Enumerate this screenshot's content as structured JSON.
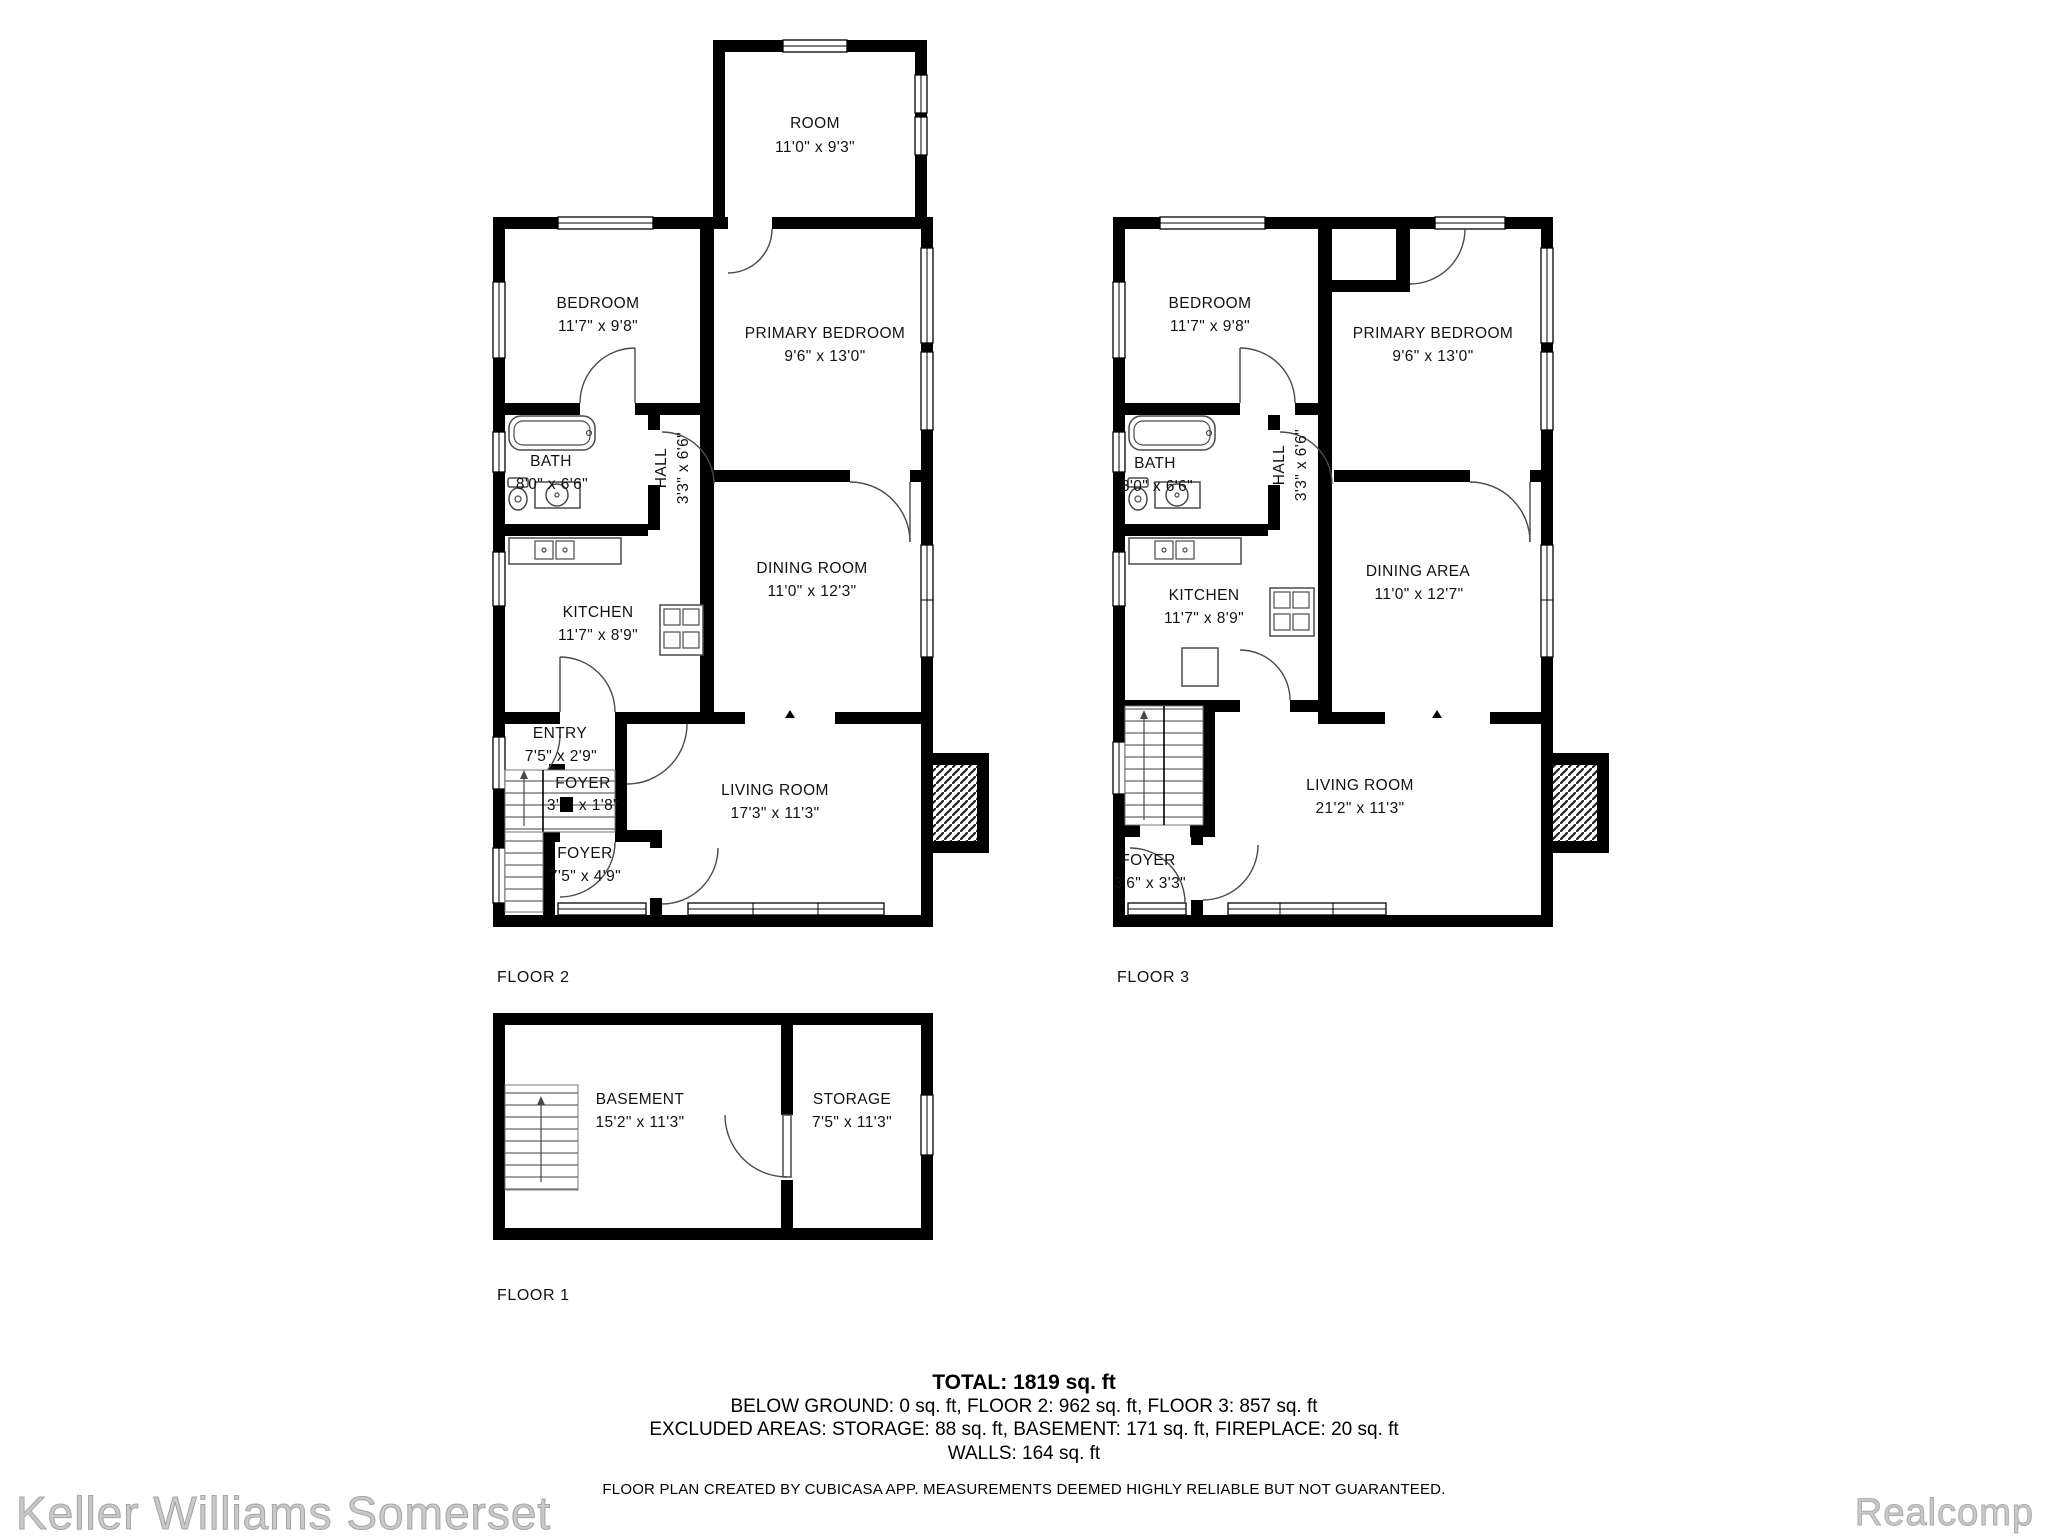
{
  "floors": [
    {
      "label": "FLOOR 2",
      "rooms": [
        {
          "name": "ROOM",
          "dims": "11'0\" x 9'3\""
        },
        {
          "name": "BEDROOM",
          "dims": "11'7\" x 9'8\""
        },
        {
          "name": "PRIMARY BEDROOM",
          "dims": "9'6\" x 13'0\""
        },
        {
          "name": "BATH",
          "dims": "8'0\" x 6'6\""
        },
        {
          "name": "HALL",
          "dims": "3'3\" x 6'6\""
        },
        {
          "name": "KITCHEN",
          "dims": "11'7\" x 8'9\""
        },
        {
          "name": "DINING ROOM",
          "dims": "11'0\" x 12'3\""
        },
        {
          "name": "ENTRY",
          "dims": "7'5\" x 2'9\""
        },
        {
          "name": "FOYER",
          "dims": "3'1\" x 1'8\""
        },
        {
          "name": "LIVING ROOM",
          "dims": "17'3\" x 11'3\""
        },
        {
          "name": "FOYER",
          "dims": "7'5\" x 4'9\""
        }
      ]
    },
    {
      "label": "FLOOR 3",
      "rooms": [
        {
          "name": "BEDROOM",
          "dims": "11'7\" x 9'8\""
        },
        {
          "name": "PRIMARY BEDROOM",
          "dims": "9'6\" x 13'0\""
        },
        {
          "name": "BATH",
          "dims": "8'0\" x 6'6\""
        },
        {
          "name": "HALL",
          "dims": "3'3\" x 6'6\""
        },
        {
          "name": "KITCHEN",
          "dims": "11'7\" x 8'9\""
        },
        {
          "name": "DINING AREA",
          "dims": "11'0\" x 12'7\""
        },
        {
          "name": "LIVING ROOM",
          "dims": "21'2\" x 11'3\""
        },
        {
          "name": "FOYER",
          "dims": "3'6\" x 3'3\""
        }
      ]
    },
    {
      "label": "FLOOR 1",
      "rooms": [
        {
          "name": "BASEMENT",
          "dims": "15'2\" x 11'3\""
        },
        {
          "name": "STORAGE",
          "dims": "7'5\" x 11'3\""
        }
      ]
    }
  ],
  "summary": {
    "total": "TOTAL: 1819 sq. ft",
    "below_ground_line": "BELOW GROUND: 0 sq. ft, FLOOR 2: 962 sq. ft, FLOOR 3: 857 sq. ft",
    "excluded_line": "EXCLUDED AREAS: STORAGE: 88 sq. ft, BASEMENT: 171 sq. ft, FIREPLACE: 20 sq. ft",
    "walls_line": "WALLS: 164 sq. ft",
    "disclaimer": "FLOOR PLAN CREATED BY CUBICASA APP. MEASUREMENTS DEEMED HIGHLY RELIABLE BUT NOT GUARANTEED."
  },
  "footer": {
    "brokerage": "Keller Williams Somerset",
    "mls": "Realcomp"
  },
  "colors": {
    "wall": "#000000",
    "background": "#ffffff",
    "label_text": "#121212",
    "logo_gray": "#c9c9c9"
  }
}
